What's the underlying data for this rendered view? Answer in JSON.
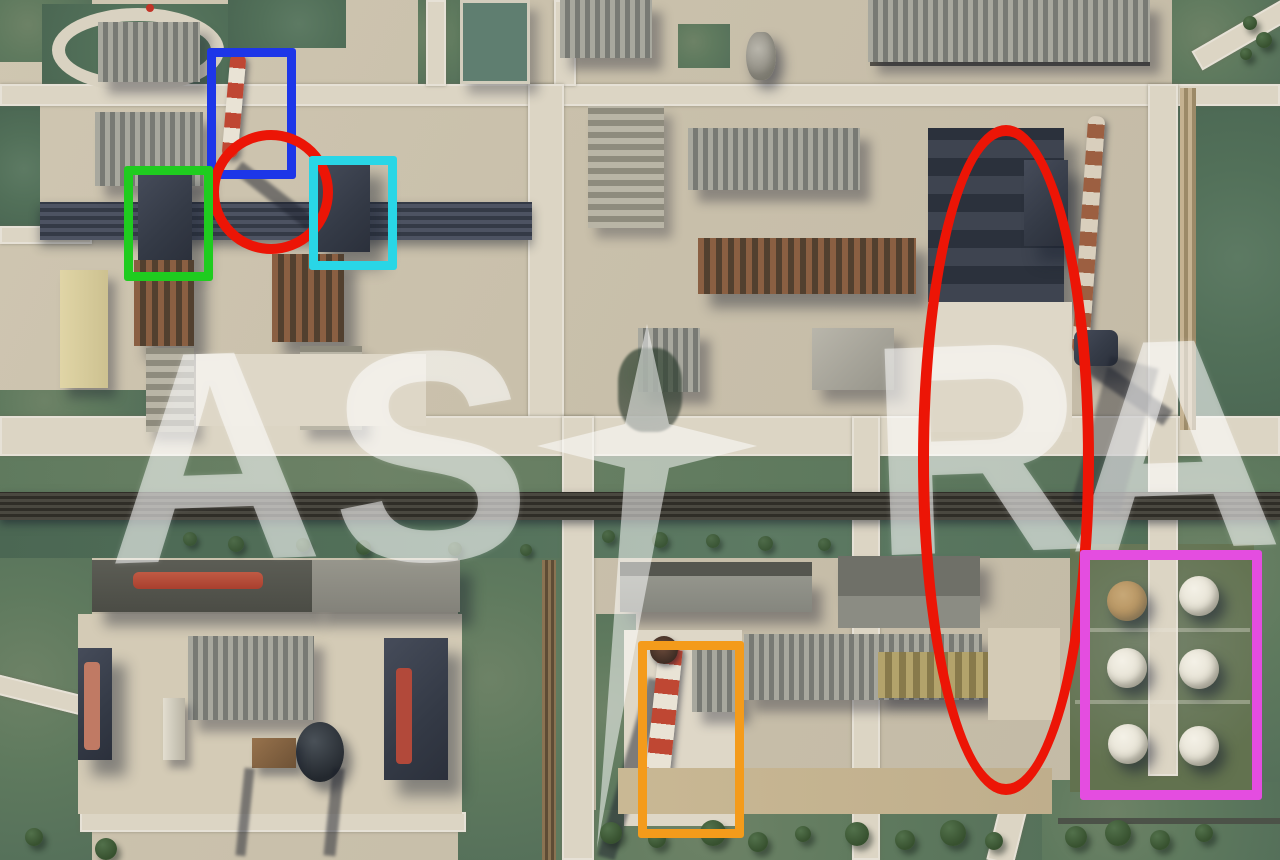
{
  "image": {
    "subject": "aerial satellite view of an industrial refinery complex",
    "watermark": {
      "text": "ASTRA",
      "letters": [
        "A",
        "S",
        "R",
        "A"
      ],
      "color": "#ffffff",
      "star_note": "letter T rendered as four-point star with elongated lower ray"
    }
  },
  "palette": {
    "grass": "#5f7a5e",
    "concrete": "#c9c0ab",
    "road": "#dcd5c4",
    "dark_structure": "#343a46",
    "chimney_red": "#bf4733",
    "chimney_white": "#e9e3d5"
  },
  "annotations": [
    {
      "id": "blue-rectangle",
      "shape": "rect",
      "color": "#1d36e8",
      "x": 207,
      "y": 48,
      "w": 71,
      "h": 113,
      "stroke": 9
    },
    {
      "id": "red-circle",
      "shape": "ellipse",
      "color": "#ec1506",
      "x": 209,
      "y": 130,
      "w": 104,
      "h": 104,
      "stroke": 10
    },
    {
      "id": "green-rectangle",
      "shape": "rect",
      "color": "#1fcc1f",
      "x": 124,
      "y": 166,
      "w": 71,
      "h": 97,
      "stroke": 9
    },
    {
      "id": "cyan-rectangle",
      "shape": "rect",
      "color": "#29d6e6",
      "x": 309,
      "y": 156,
      "w": 70,
      "h": 96,
      "stroke": 9
    },
    {
      "id": "red-ellipse",
      "shape": "ellipse",
      "color": "#ec1506",
      "x": 918,
      "y": 125,
      "w": 154,
      "h": 648,
      "stroke": 11
    },
    {
      "id": "orange-rectangle",
      "shape": "rect",
      "color": "#f49b1b",
      "x": 638,
      "y": 641,
      "w": 88,
      "h": 179,
      "stroke": 9
    },
    {
      "id": "magenta-rectangle",
      "shape": "rect",
      "color": "#e44de0",
      "x": 1080,
      "y": 550,
      "w": 162,
      "h": 230,
      "stroke": 10
    }
  ]
}
